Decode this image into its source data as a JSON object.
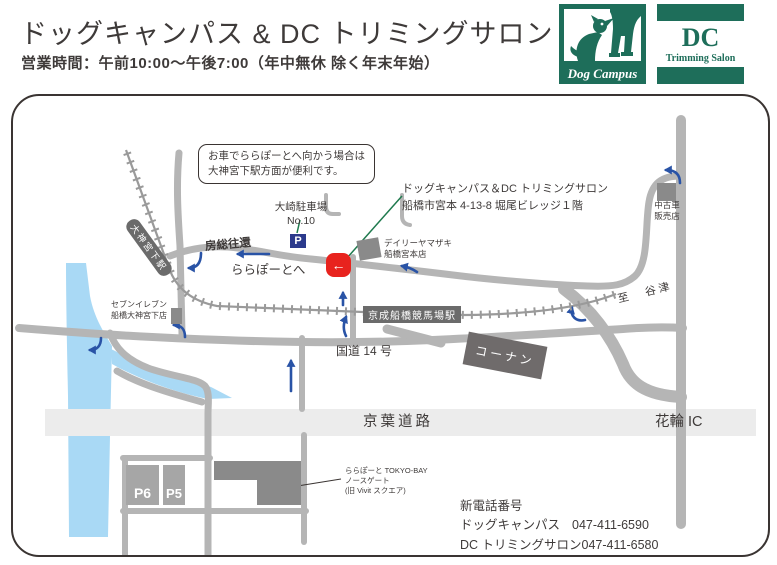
{
  "header": {
    "title": "ドッグキャンパス & DC トリミングサロン",
    "hours": "営業時間：午前10:00～午後7:00（年中無休 除く年末年始）"
  },
  "logos": {
    "dog_campus": {
      "label": "Dog Campus"
    },
    "dc": {
      "initials": "DC",
      "label": "Trimming Salon"
    },
    "brand_green": "#1e6e5a"
  },
  "map": {
    "note": {
      "line1": "お車でららぽーとへ向かう場合は",
      "line2": "大神宮下駅方面が便利です。"
    },
    "labels": {
      "osaki_parking": {
        "line1": "大崎駐車場",
        "line2": "No.10"
      },
      "parking_p": "P",
      "boso_okan": "房総往還",
      "to_lalaport": "ららぽーとへ",
      "shop_callout": {
        "line1": "ドッグキャンパス＆DC トリミングサロン",
        "line2": "船橋市宮本 4-13-8 堀尾ビレッジ１階"
      },
      "daily_yamazaki": {
        "line1": "デイリーヤマザキ",
        "line2": "船橋宮本店"
      },
      "used_car": {
        "line1": "中古車",
        "line2": "販売店"
      },
      "to_yatsu": "至　谷津",
      "seven_eleven": {
        "line1": "セブンイレブン",
        "line2": "船橋大神宮下店"
      },
      "daijingushita_station": "大神宮下駅",
      "keisei_station": "京成船橋競馬場駅",
      "route14": "国道 14 号",
      "konan": "コーナン",
      "keiyo_road": "京葉道路",
      "hanawa_ic": "花輪 IC",
      "lalaport": {
        "line1": "ららぽーと TOKYO-BAY",
        "line2": "ノースゲート",
        "line3": "(旧 Vivit スクエア)"
      },
      "p6": "P6",
      "p5": "P5"
    },
    "contact": {
      "heading": "新電話番号",
      "rows": [
        {
          "name": "ドッグキャンパス",
          "phone": "047-411-6590"
        },
        {
          "name": "DC トリミングサロン",
          "phone": "047-411-6580"
        }
      ]
    },
    "icons": {
      "marker_arrow": "←"
    },
    "colors": {
      "road": "#b5b5b5",
      "highway_band": "#ececec",
      "water": "#a9d9f5",
      "building": "#8a8a8a",
      "station": "#6b6b6b",
      "arrow_blue": "#2953a6",
      "marker_red": "#e8231e",
      "parking_navy": "#2b3a8c",
      "leader_green": "#1f7a4e",
      "brand_green": "#1e6e5a"
    }
  }
}
